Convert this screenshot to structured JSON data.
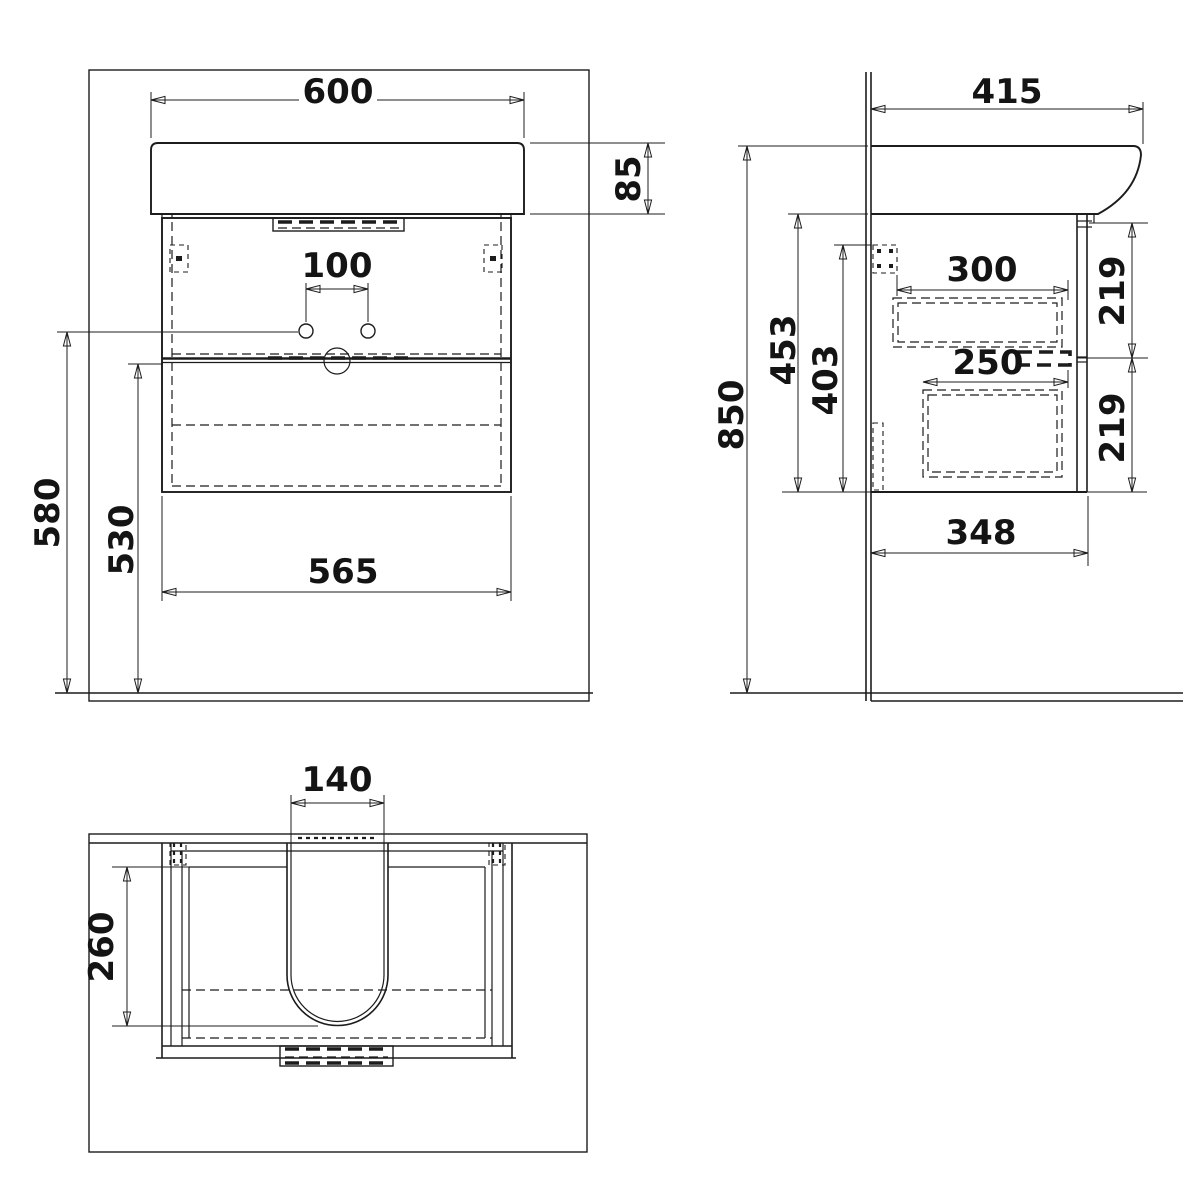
{
  "drawing": {
    "type": "technical-dimension-drawing",
    "subject": "wall-hung washbasin vanity unit, three orthographic views",
    "background_color": "#ffffff",
    "line_color": "#1c1c1c",
    "views": {
      "front": {
        "label": "front-view",
        "dims": {
          "basin_width": "600",
          "basin_height": "85",
          "faucet_hole_spacing": "100",
          "floor_to_hole_height": "580",
          "floor_to_drawer_gap": "530",
          "cabinet_width": "565"
        }
      },
      "side": {
        "label": "side-view",
        "dims": {
          "basin_depth": "415",
          "floor_to_basin_top": "850",
          "cabinet_height": "453",
          "bracket_height": "403",
          "upper_drawer_depth": "300",
          "lower_drawer_depth": "250",
          "upper_drawer_front_height": "219",
          "lower_drawer_front_height": "219",
          "cabinet_depth": "348"
        }
      },
      "plan": {
        "label": "plan-view",
        "dims": {
          "siphon_cutout_width": "140",
          "siphon_cutout_depth": "260"
        }
      }
    }
  }
}
